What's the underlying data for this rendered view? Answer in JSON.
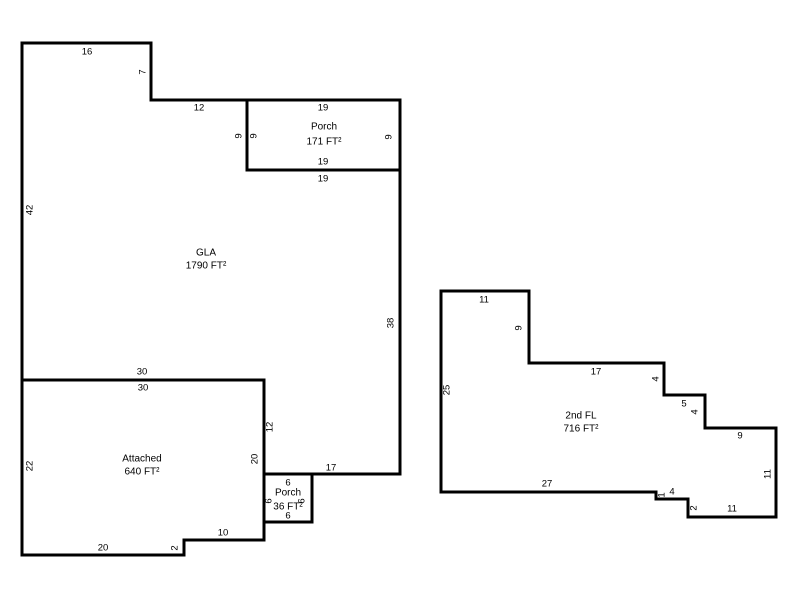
{
  "canvas": {
    "width": 800,
    "height": 600,
    "background_color": "#ffffff",
    "line_color": "#000000",
    "text_color": "#000000",
    "line_width": 3
  },
  "areas": [
    {
      "name": "gla",
      "label_x": 206,
      "label_lines": [
        {
          "text": "GLA",
          "y": 253
        },
        {
          "text": "1790 FT²",
          "y": 266
        }
      ],
      "points": [
        [
          22,
          43
        ],
        [
          151,
          43
        ],
        [
          151,
          100
        ],
        [
          247,
          100
        ],
        [
          247,
          170
        ],
        [
          400,
          170
        ],
        [
          400,
          474
        ],
        [
          264,
          474
        ],
        [
          264,
          380
        ],
        [
          22,
          380
        ]
      ],
      "dimensions": [
        {
          "text": "16",
          "x": 87,
          "y": 52
        },
        {
          "text": "7",
          "x": 143,
          "y": 72,
          "rotated": true
        },
        {
          "text": "12",
          "x": 199,
          "y": 108
        },
        {
          "text": "9",
          "x": 239,
          "y": 136,
          "rotated": true
        },
        {
          "text": "19",
          "x": 323,
          "y": 179
        },
        {
          "text": "42",
          "x": 30,
          "y": 210,
          "rotated": true
        },
        {
          "text": "38",
          "x": 391,
          "y": 323,
          "rotated": true
        },
        {
          "text": "30",
          "x": 142,
          "y": 372
        },
        {
          "text": "12",
          "x": 270,
          "y": 427,
          "rotated": true
        },
        {
          "text": "17",
          "x": 331,
          "y": 468
        }
      ]
    },
    {
      "name": "porch-upper",
      "label_x": 324,
      "label_lines": [
        {
          "text": "Porch",
          "y": 127
        },
        {
          "text": "171 FT²",
          "y": 142
        }
      ],
      "points": [
        [
          247,
          100
        ],
        [
          400,
          100
        ],
        [
          400,
          170
        ],
        [
          247,
          170
        ]
      ],
      "dimensions": [
        {
          "text": "19",
          "x": 323,
          "y": 108
        },
        {
          "text": "9",
          "x": 254,
          "y": 136,
          "rotated": true
        },
        {
          "text": "9",
          "x": 389,
          "y": 137,
          "rotated": true
        },
        {
          "text": "19",
          "x": 323,
          "y": 162
        }
      ]
    },
    {
      "name": "attached",
      "label_x": 142,
      "label_lines": [
        {
          "text": "Attached",
          "y": 459
        },
        {
          "text": "640 FT²",
          "y": 472
        }
      ],
      "points": [
        [
          22,
          380
        ],
        [
          264,
          380
        ],
        [
          264,
          540
        ],
        [
          184,
          540
        ],
        [
          184,
          555
        ],
        [
          22,
          555
        ]
      ],
      "dimensions": [
        {
          "text": "30",
          "x": 143,
          "y": 388
        },
        {
          "text": "20",
          "x": 255,
          "y": 459,
          "rotated": true
        },
        {
          "text": "22",
          "x": 30,
          "y": 466,
          "rotated": true
        },
        {
          "text": "10",
          "x": 223,
          "y": 533
        },
        {
          "text": "2",
          "x": 175,
          "y": 548,
          "rotated": true
        },
        {
          "text": "20",
          "x": 103,
          "y": 548
        }
      ]
    },
    {
      "name": "porch-lower",
      "label_x": 288,
      "label_lines": [
        {
          "text": "Porch",
          "y": 493
        },
        {
          "text": "36 FT²",
          "y": 507
        }
      ],
      "points": [
        [
          264,
          474
        ],
        [
          312,
          474
        ],
        [
          312,
          522
        ],
        [
          264,
          522
        ]
      ],
      "dimensions": [
        {
          "text": "6",
          "x": 288,
          "y": 483
        },
        {
          "text": "6",
          "x": 269,
          "y": 501,
          "rotated": true
        },
        {
          "text": "6",
          "x": 302,
          "y": 501,
          "rotated": true
        },
        {
          "text": "6",
          "x": 288,
          "y": 516
        }
      ]
    },
    {
      "name": "second-floor",
      "label_x": 581,
      "label_lines": [
        {
          "text": "2nd FL",
          "y": 416
        },
        {
          "text": "716 FT²",
          "y": 429
        }
      ],
      "points": [
        [
          441,
          291
        ],
        [
          529,
          291
        ],
        [
          529,
          363
        ],
        [
          664,
          363
        ],
        [
          664,
          395
        ],
        [
          705,
          395
        ],
        [
          705,
          428
        ],
        [
          776,
          428
        ],
        [
          776,
          517
        ],
        [
          688,
          517
        ],
        [
          688,
          499
        ],
        [
          656,
          499
        ],
        [
          656,
          492
        ],
        [
          441,
          492
        ]
      ],
      "dimensions": [
        {
          "text": "11",
          "x": 484,
          "y": 300
        },
        {
          "text": "9",
          "x": 519,
          "y": 328,
          "rotated": true
        },
        {
          "text": "17",
          "x": 596,
          "y": 372
        },
        {
          "text": "4",
          "x": 656,
          "y": 379,
          "rotated": true
        },
        {
          "text": "25",
          "x": 447,
          "y": 390,
          "rotated": true
        },
        {
          "text": "5",
          "x": 684,
          "y": 404
        },
        {
          "text": "4",
          "x": 695,
          "y": 412,
          "rotated": true
        },
        {
          "text": "9",
          "x": 740,
          "y": 436
        },
        {
          "text": "11",
          "x": 768,
          "y": 474,
          "rotated": true
        },
        {
          "text": "27",
          "x": 547,
          "y": 484
        },
        {
          "text": "1",
          "x": 662,
          "y": 495,
          "rotated": true
        },
        {
          "text": "4",
          "x": 672,
          "y": 492
        },
        {
          "text": "2",
          "x": 694,
          "y": 508,
          "rotated": true
        },
        {
          "text": "11",
          "x": 732,
          "y": 509
        }
      ]
    }
  ]
}
